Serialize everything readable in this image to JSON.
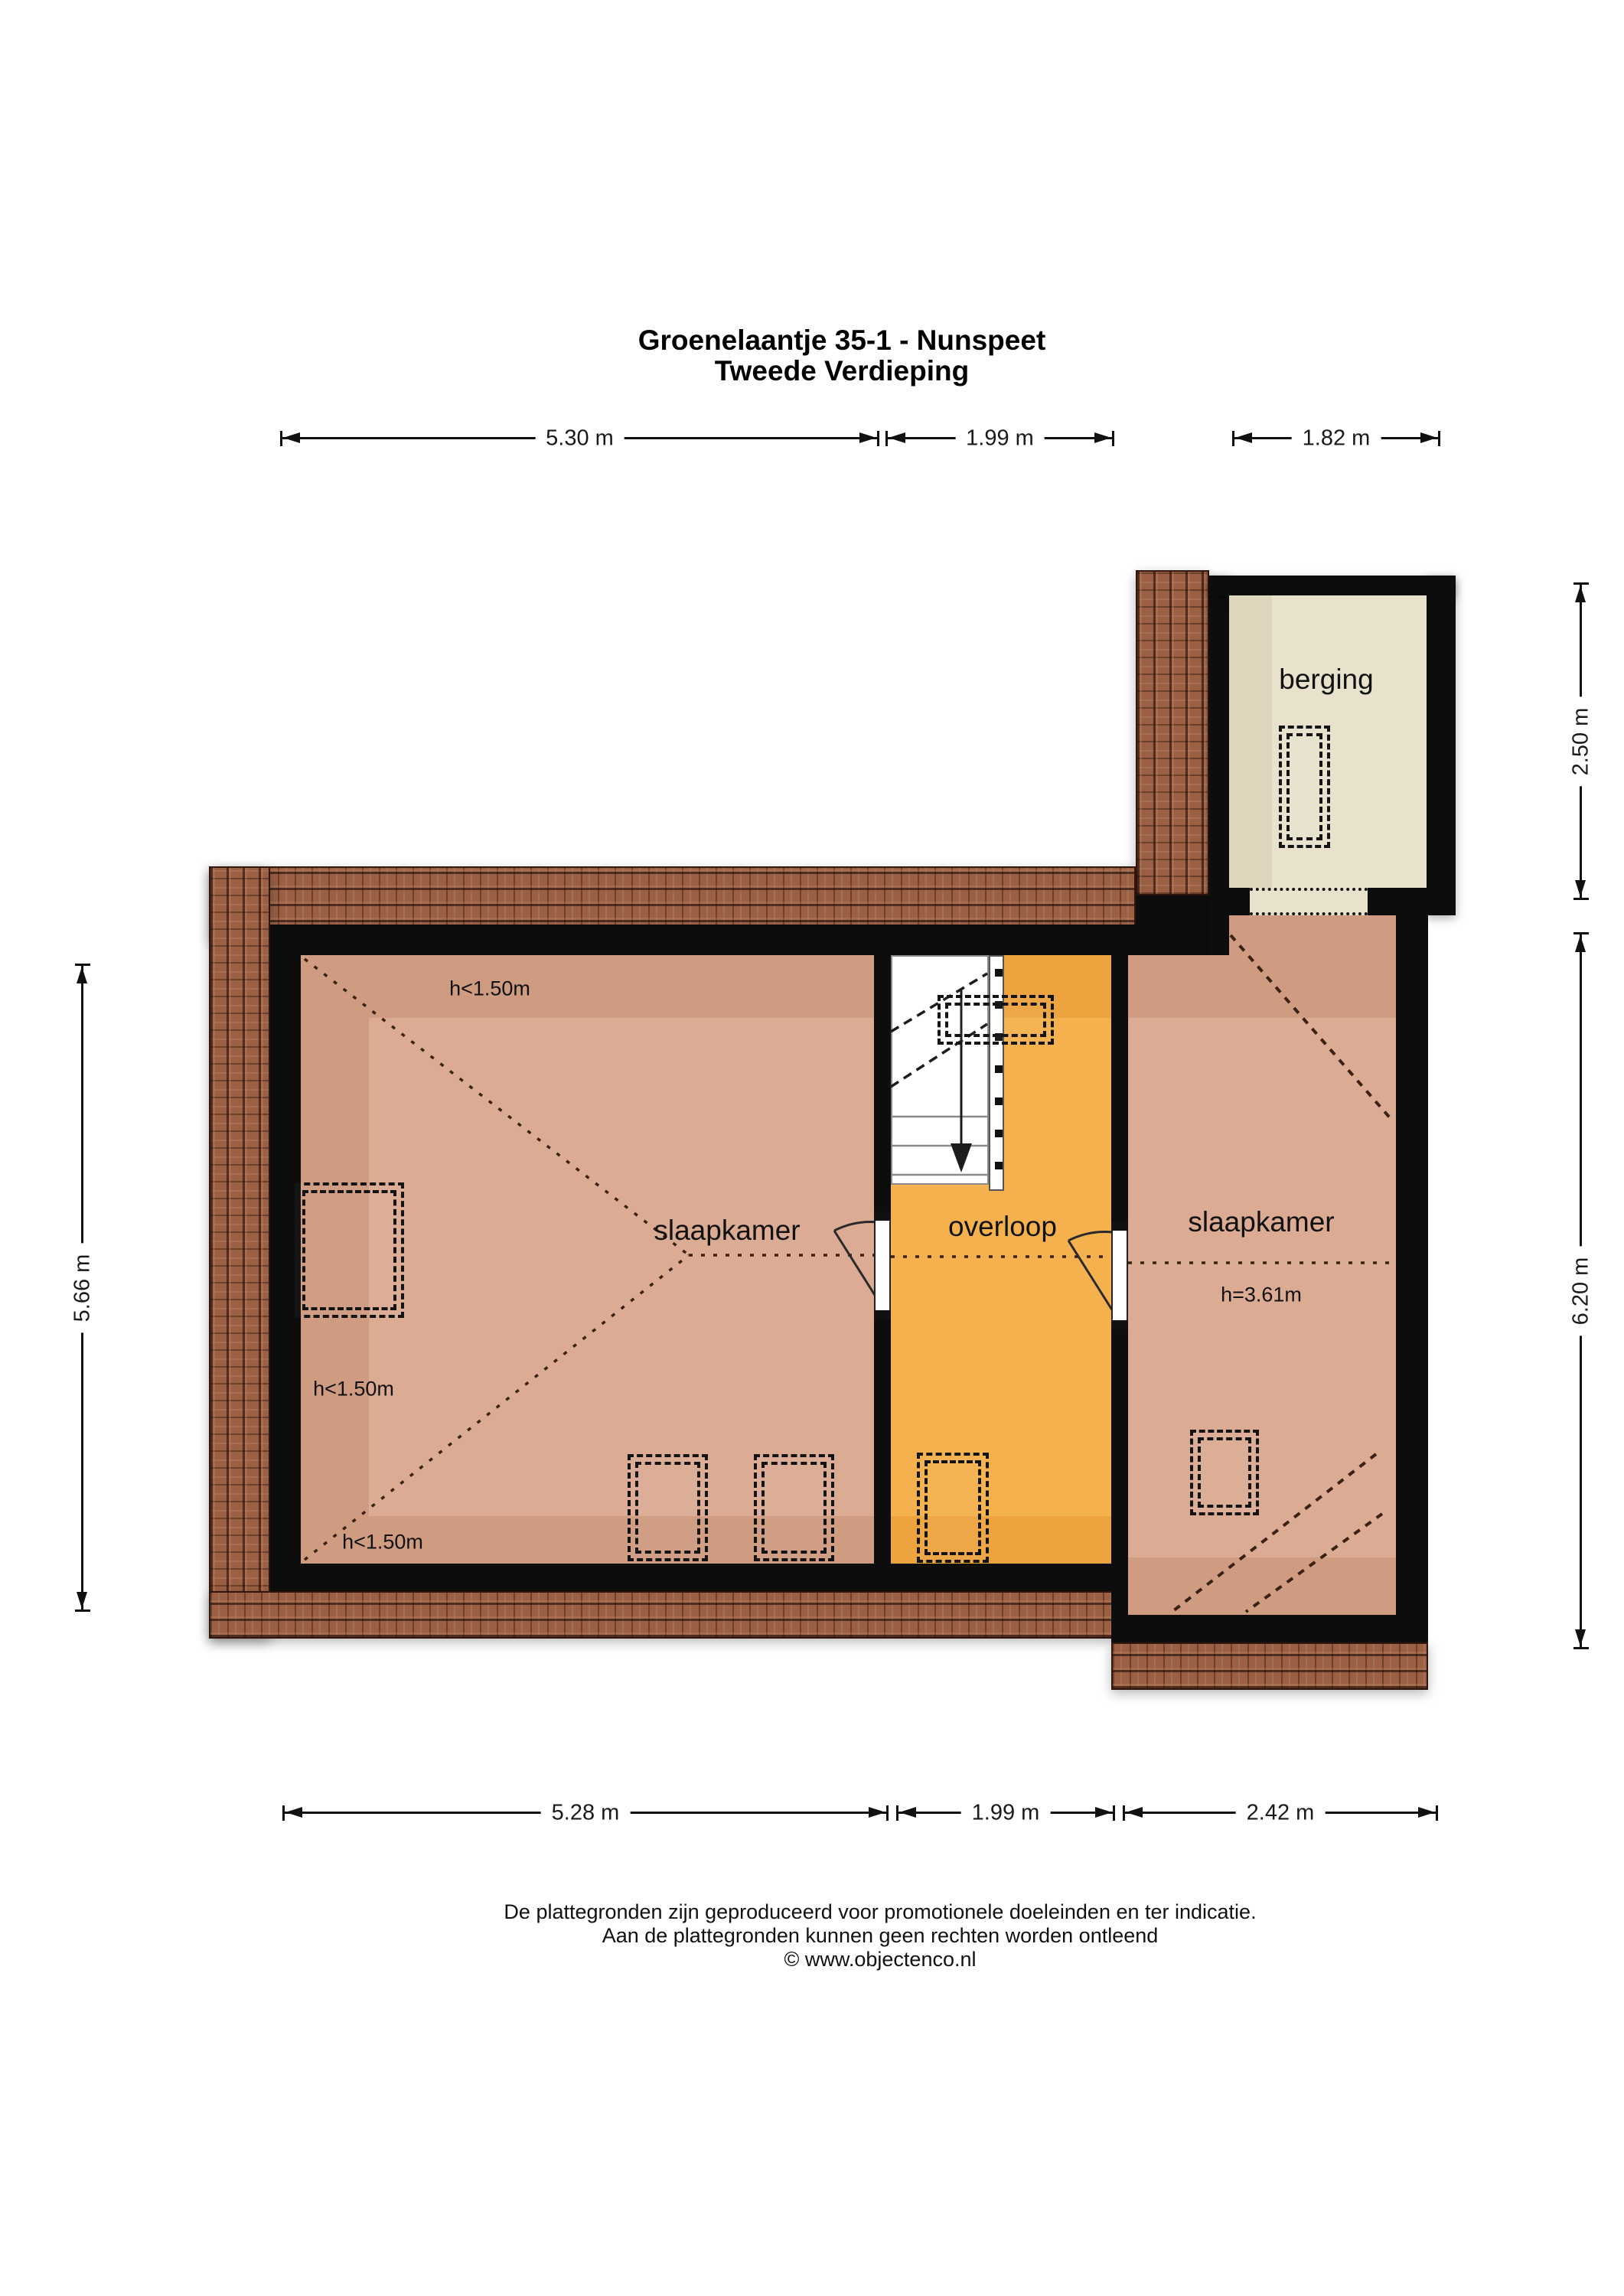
{
  "title": {
    "line1": "Groenelaantje 35-1 - Nunspeet",
    "line2": "Tweede Verdieping"
  },
  "rooms": {
    "berging": "berging",
    "slaapkamer_left": "slaapkamer",
    "overloop": "overloop",
    "slaapkamer_right": "slaapkamer"
  },
  "height_labels": {
    "top_left_room": "h<1.50m",
    "left_room_side": "h<1.50m",
    "bottom_left_room": "h<1.50m",
    "right_room": "h=3.61m"
  },
  "dimensions": {
    "top": [
      "5.30 m",
      "1.99 m",
      "1.82 m"
    ],
    "bottom": [
      "5.28 m",
      "1.99 m",
      "2.42 m"
    ],
    "left": [
      "5.66 m"
    ],
    "right": [
      "2.50 m",
      "6.20 m"
    ]
  },
  "footer": {
    "line1": "De plattegronden zijn geproduceerd voor promotionele doeleinden en ter indicatie.",
    "line2": "Aan de plattegronden kunnen geen rechten worden ontleend",
    "line3": "© www.objectenco.nl"
  },
  "colors": {
    "wall": "#0d0d0d",
    "floor_salmon": "#cf9b81",
    "floor_salmon_light": "#dcab93",
    "floor_orange": "#eda43f",
    "floor_orange_light": "#f5b14e",
    "floor_beige": "#e8e2cc",
    "roof_tile": "#9b5f43",
    "dash_line": "#3a2113"
  }
}
